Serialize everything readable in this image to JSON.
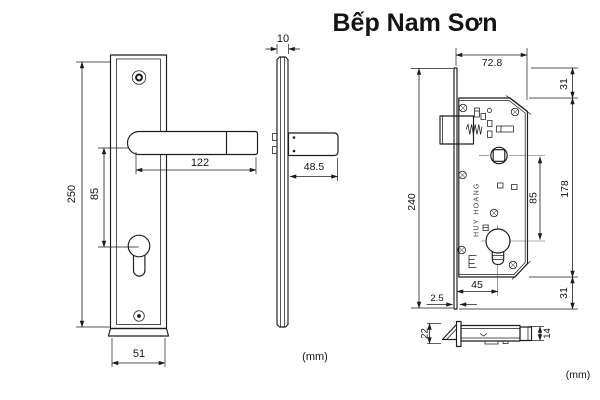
{
  "title": "Bếp Nam Sơn",
  "title_color": "#e8232e",
  "front_view": {
    "height": "250",
    "center_offset": "85",
    "handle_length": "122",
    "width": "51"
  },
  "side_view": {
    "thickness": "10",
    "handle_depth": "48.5"
  },
  "lock_view": {
    "width": "72.8",
    "top_offset": "31",
    "body_height": "178",
    "total_height": "240",
    "backset": "45",
    "faceplate_offset": "2.5",
    "bottom_offset": "31",
    "spindle_to_cylinder": "85",
    "brand_text": "HUY HOANG"
  },
  "latch_part": {
    "height": "22",
    "bolt_height": "14"
  },
  "units": {
    "left": "(mm)",
    "right": "(mm)"
  }
}
